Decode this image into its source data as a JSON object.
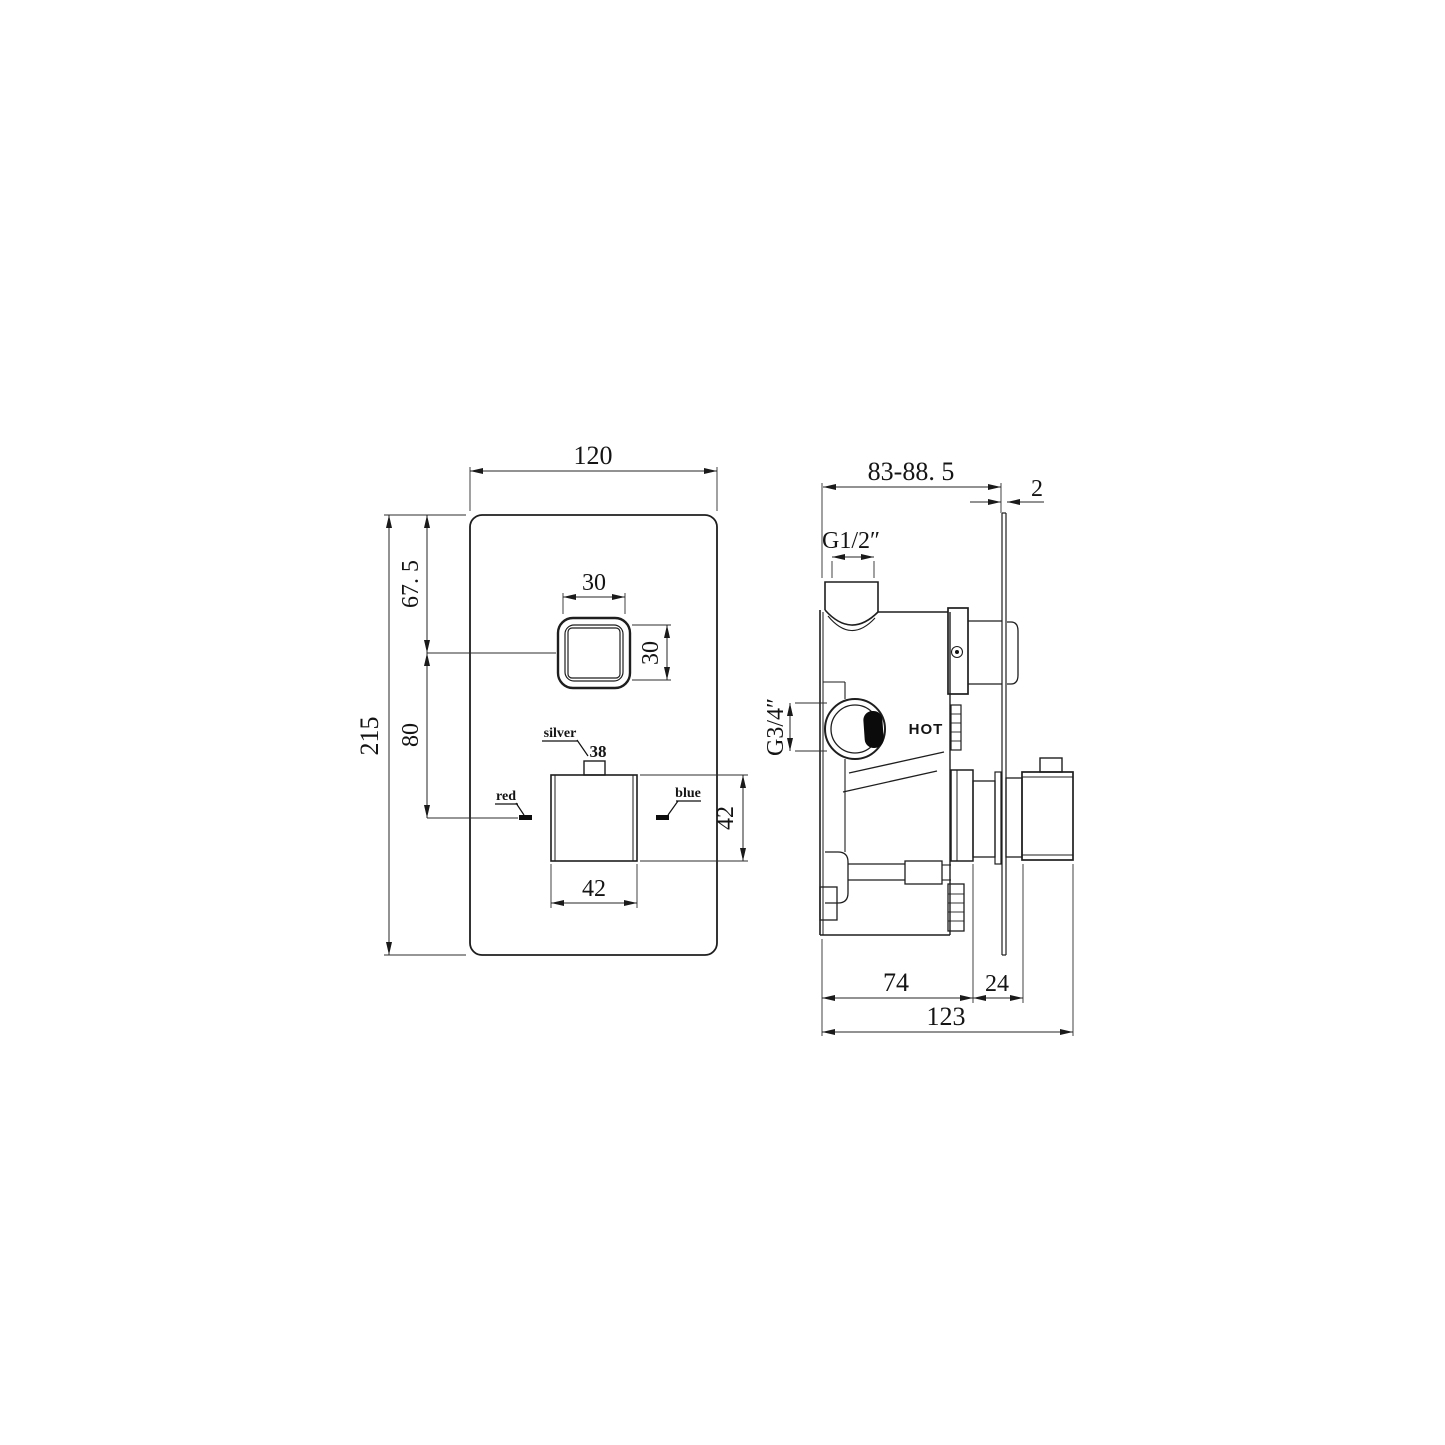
{
  "drawing": {
    "front_view": {
      "plate_width": "120",
      "plate_height": "215",
      "top_to_button": "67. 5",
      "button_to_handle": "80",
      "button_width": "30",
      "button_height": "30",
      "handle_width": "42",
      "handle_height": "42",
      "silver_label": "silver",
      "temp_label": "38",
      "red_label": "red",
      "blue_label": "blue"
    },
    "side_view": {
      "depth_range": "83-88. 5",
      "plate_thickness": "2",
      "inlet_thread": "G1/2″",
      "port_thread": "G3/4″",
      "hot_label": "HOT",
      "body_depth": "74",
      "handle_depth": "24",
      "total_depth": "123"
    }
  }
}
